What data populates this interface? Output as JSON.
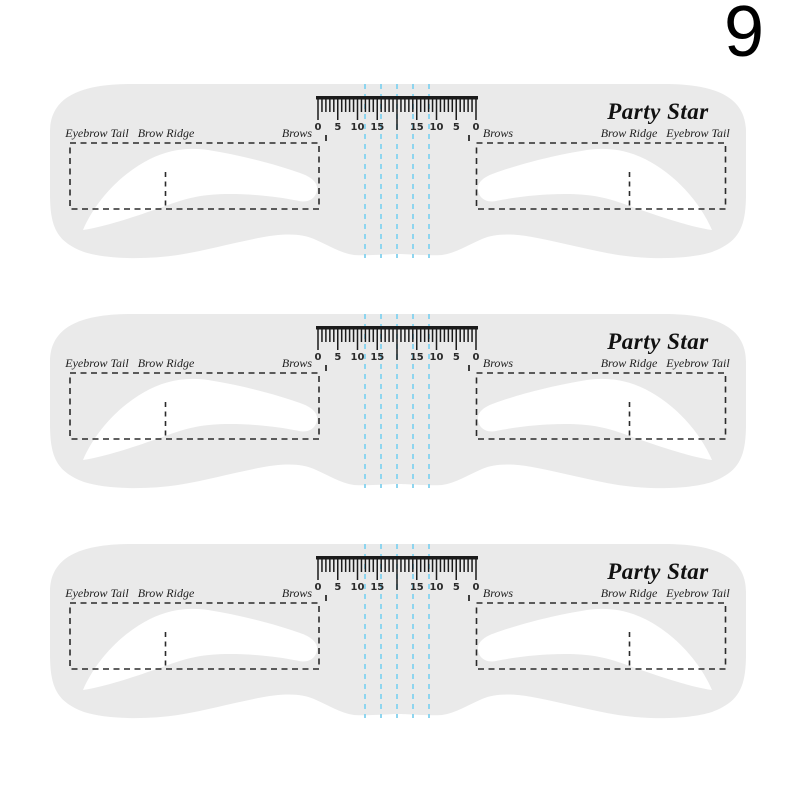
{
  "page": {
    "background": "#ffffff",
    "variant_number": "9"
  },
  "stencil": {
    "brand": "Party Star",
    "count": 3,
    "base_color": "#eaeaea",
    "cutout_color": "#ffffff",
    "guide_color": "#2b2b2b",
    "ruler_ink": "#1b1b1b",
    "center_guide_color": "#8ed5ef",
    "labels": {
      "left": {
        "tail": "Eyebrow Tail",
        "ridge": "Brow Ridge",
        "brows": "Brows"
      },
      "right": {
        "brows": "Brows",
        "ridge": "Brow Ridge",
        "tail": "Eyebrow Tail"
      }
    },
    "ruler": {
      "numbers_left": [
        "0",
        "5",
        "10",
        "15"
      ],
      "numbers_right": [
        "15",
        "10",
        "5",
        "0"
      ]
    }
  }
}
